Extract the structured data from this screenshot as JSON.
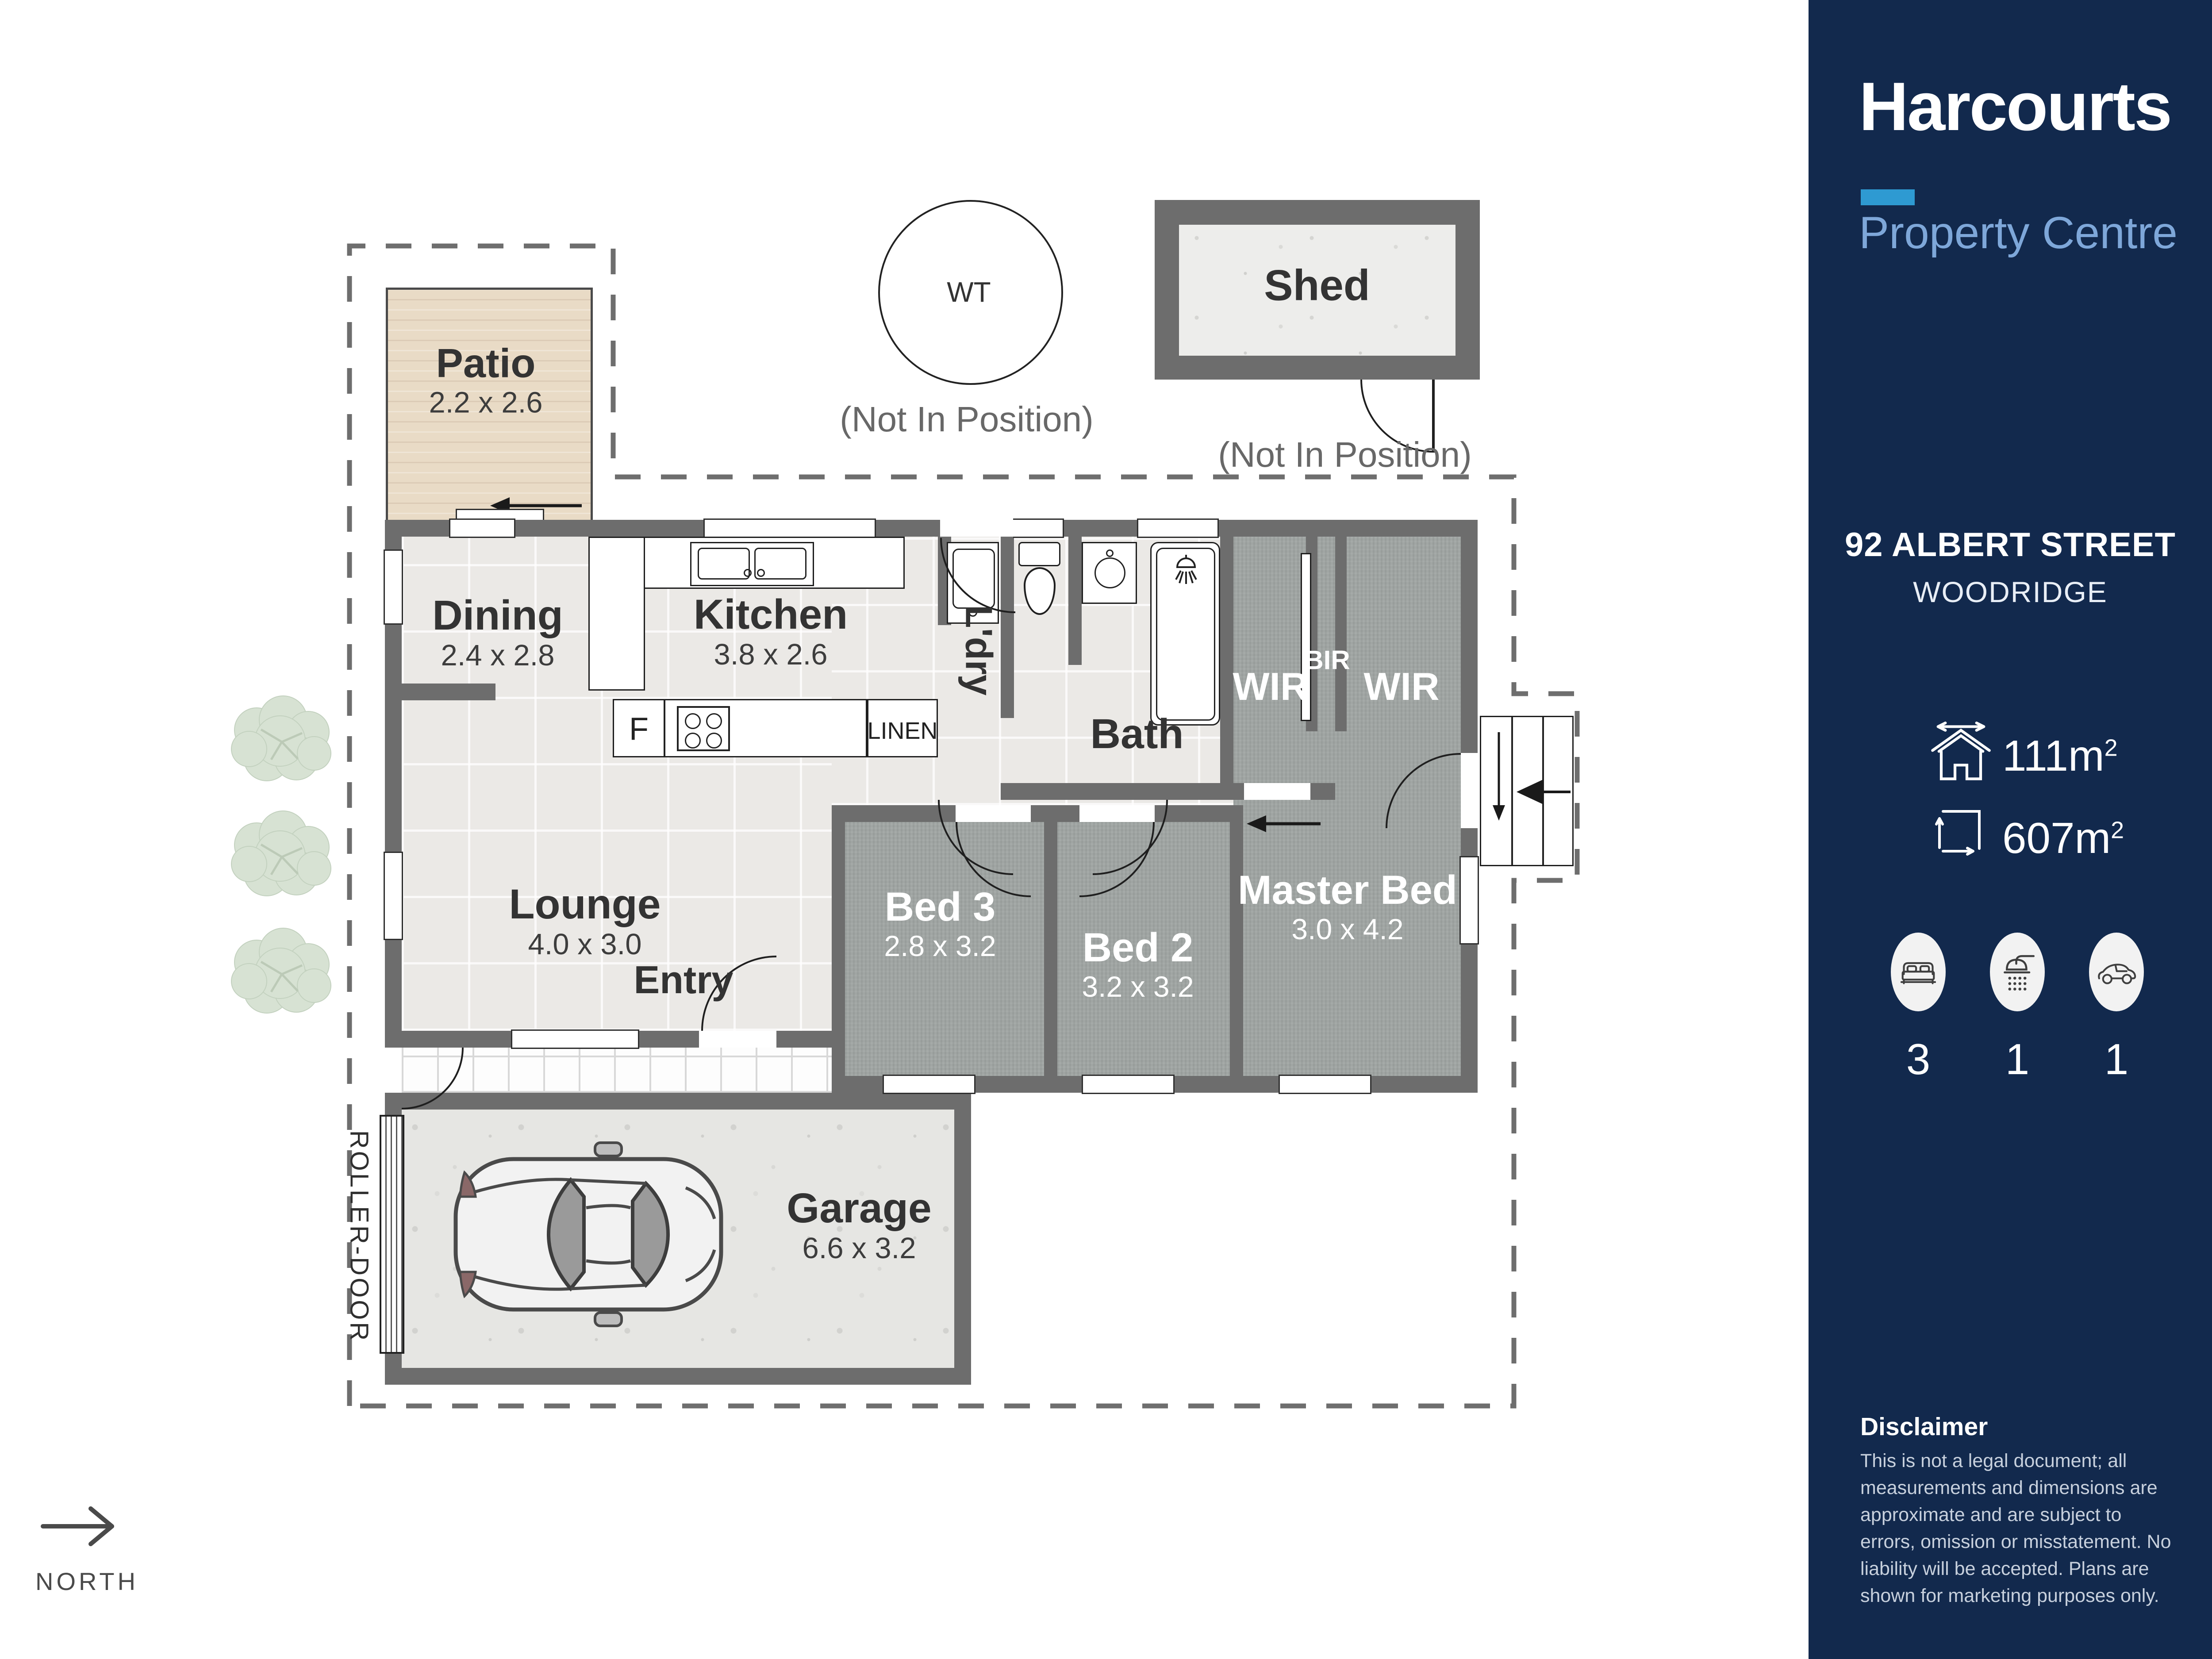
{
  "brand": {
    "name": "Harcourts",
    "tagline": "Property Centre",
    "accent_color": "#2e9ad2",
    "tagline_color": "#7ea7d9",
    "sidebar_bg_color": "#12294d"
  },
  "listing": {
    "street": "92 ALBERT STREET",
    "suburb": "WOODRIDGE"
  },
  "stats": {
    "floor_area": {
      "icon": "house-area-icon",
      "value": "111m",
      "sup": "2"
    },
    "land_area": {
      "icon": "land-area-icon",
      "value": "607m",
      "sup": "2"
    },
    "features": [
      {
        "icon": "bed-icon",
        "count": "3"
      },
      {
        "icon": "shower-icon",
        "count": "1"
      },
      {
        "icon": "car-icon",
        "count": "1"
      }
    ]
  },
  "disclaimer": {
    "title": "Disclaimer",
    "body": "This is not a legal document; all measurements and dimensions are approximate and are subject to errors, omission or misstatement. No liability will be accepted. Plans are shown for marketing purposes only."
  },
  "plan": {
    "north": "NORTH",
    "roller_door": "ROLLER-DOOR",
    "fridge": "F",
    "linen": "LINEN",
    "water_tank": {
      "label": "WT",
      "note": "(Not In Position)"
    },
    "shed": {
      "name": "Shed",
      "note": "(Not In Position)"
    },
    "rooms": {
      "patio": {
        "name": "Patio",
        "dims": "2.2 x 2.6"
      },
      "dining": {
        "name": "Dining",
        "dims": "2.4 x 2.8"
      },
      "kitchen": {
        "name": "Kitchen",
        "dims": "3.8 x 2.6"
      },
      "laundry": {
        "name": "L'dry"
      },
      "bath": {
        "name": "Bath"
      },
      "wir1": {
        "name": "WIR"
      },
      "bir": {
        "name": "BIR"
      },
      "wir2": {
        "name": "WIR"
      },
      "lounge": {
        "name": "Lounge",
        "dims": "4.0 x 3.0"
      },
      "entry": {
        "name": "Entry"
      },
      "bed3": {
        "name": "Bed 3",
        "dims": "2.8 x 3.2"
      },
      "bed2": {
        "name": "Bed 2",
        "dims": "3.2 x 3.2"
      },
      "master": {
        "name": "Master Bed",
        "dims": "3.0 x 4.2"
      },
      "garage": {
        "name": "Garage",
        "dims": "6.6 x 3.2"
      }
    }
  }
}
